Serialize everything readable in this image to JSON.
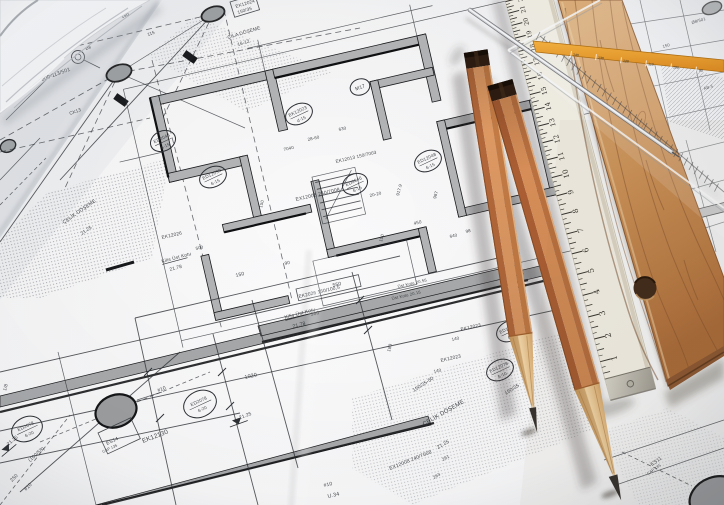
{
  "scene_colors": {
    "paper": "#f6f6f7",
    "blueprint_ink": "#2e3135",
    "wall_fill": "#b3b5b7",
    "pencil_wood": "#e09a63",
    "ruler_wood": "#c88f5e",
    "ruler_cream": "#f1eee4",
    "stripe_orange": "#efa33c",
    "graphite": "#332f2c"
  },
  "white_ruler": {
    "numbers": [
      "0",
      "1",
      "2",
      "3",
      "4",
      "5",
      "6",
      "7",
      "8",
      "9",
      "10",
      "11",
      "12",
      "13",
      "14",
      "15",
      "16",
      "17",
      "18",
      "19",
      "20",
      "21",
      "22",
      "23"
    ]
  },
  "set_square": {
    "scale_numbers": [
      "140",
      "130",
      "120",
      "110",
      "100",
      "90"
    ]
  },
  "blueprint": {
    "labels": [
      {
        "t": "EK12024",
        "x": 236,
        "y": 8,
        "r": -17,
        "s": 4.6
      },
      {
        "t": "150/35",
        "x": 238,
        "y": 14,
        "r": -17,
        "s": 4.6
      },
      {
        "t": "ÇILA DÖŞEME",
        "x": 228,
        "y": 39,
        "r": -17,
        "s": 4.8
      },
      {
        "t": "16-12",
        "x": 238,
        "y": 46,
        "r": -17,
        "s": 4.6
      },
      {
        "t": "800-113/501",
        "x": 42,
        "y": 81,
        "r": -20,
        "s": 5.2
      },
      {
        "t": "CK13",
        "x": 70,
        "y": 115,
        "r": -20,
        "s": 4.6
      },
      {
        "t": "-180/501",
        "x": 60,
        "y": 9,
        "r": -20,
        "s": 4.4
      },
      {
        "t": "150",
        "x": 122,
        "y": 18,
        "r": -20,
        "s": 4.4
      },
      {
        "t": "115",
        "x": 148,
        "y": 36,
        "r": -20,
        "s": 4.4
      },
      {
        "t": "Ø8",
        "x": 86,
        "y": 50,
        "r": -20,
        "s": 4
      },
      {
        "t": "EX12008  240/7008",
        "x": 296,
        "y": 201,
        "r": -13,
        "s": 5
      },
      {
        "t": "EK12013  150/7003",
        "x": 336,
        "y": 163,
        "r": -13,
        "s": 4.6
      },
      {
        "t": "28-60",
        "x": 308,
        "y": 141,
        "r": -13,
        "s": 4.4
      },
      {
        "t": "7040",
        "x": 284,
        "y": 151,
        "r": -13,
        "s": 4.4
      },
      {
        "t": "20-20",
        "x": 370,
        "y": 197,
        "r": -13,
        "s": 4.4
      },
      {
        "t": "917.9",
        "x": 399,
        "y": 196,
        "r": -75,
        "s": 4.4
      },
      {
        "t": "987",
        "x": 436,
        "y": 199,
        "r": -75,
        "s": 4.4
      },
      {
        "t": "450",
        "x": 414,
        "y": 225,
        "r": -13,
        "s": 4.6
      },
      {
        "t": "630",
        "x": 339,
        "y": 131,
        "r": -13,
        "s": 4.4
      },
      {
        "t": "640",
        "x": 450,
        "y": 238,
        "r": -13,
        "s": 4.4
      },
      {
        "t": "98",
        "x": 466,
        "y": 233,
        "r": -13,
        "s": 4.4
      },
      {
        "t": "150",
        "x": 262,
        "y": 208,
        "r": -75,
        "s": 4.4
      },
      {
        "t": "150",
        "x": 382,
        "y": 242,
        "r": -75,
        "s": 4.4
      },
      {
        "t": "EK12023",
        "x": 461,
        "y": 331,
        "r": -13,
        "s": 4.8
      },
      {
        "t": "140",
        "x": 452,
        "y": 341,
        "r": -13,
        "s": 4.4
      },
      {
        "t": "EK12023",
        "x": 441,
        "y": 362,
        "r": -13,
        "s": 4.8
      },
      {
        "t": "140",
        "x": 434,
        "y": 373,
        "r": -13,
        "s": 4.4
      },
      {
        "t": "150/35-50",
        "x": 414,
        "y": 392,
        "r": -33,
        "s": 5
      },
      {
        "t": "150/35",
        "x": 506,
        "y": 395,
        "r": -33,
        "s": 5
      },
      {
        "t": "Kilis Üst Kotu",
        "x": 162,
        "y": 263,
        "r": -15,
        "s": 4.8,
        "u": 26
      },
      {
        "t": "21.78",
        "x": 170,
        "y": 271,
        "r": -15,
        "s": 4.8
      },
      {
        "t": "Kilis Üst Kotu",
        "x": 285,
        "y": 319,
        "r": -15,
        "s": 5,
        "u": 28
      },
      {
        "t": "21.78",
        "x": 293,
        "y": 328,
        "r": -15,
        "s": 5
      },
      {
        "t": "EK2026  150/100,5",
        "x": 299,
        "y": 298,
        "r": -13,
        "s": 4.8
      },
      {
        "t": "550",
        "x": 333,
        "y": 287,
        "r": -13,
        "s": 5
      },
      {
        "t": "360",
        "x": 311,
        "y": 316,
        "r": -13,
        "s": 5
      },
      {
        "t": "150",
        "x": 236,
        "y": 277,
        "r": -13,
        "s": 5
      },
      {
        "t": "90",
        "x": 285,
        "y": 265,
        "r": -13,
        "s": 4.6
      },
      {
        "t": "180",
        "x": 390,
        "y": 352,
        "r": -75,
        "s": 4.6
      },
      {
        "t": "1020",
        "x": 245,
        "y": 379,
        "r": -13,
        "s": 5.4
      },
      {
        "t": "#10",
        "x": 158,
        "y": 392,
        "r": -20,
        "s": 5
      },
      {
        "t": "EK12130",
        "x": 143,
        "y": 443,
        "r": -21,
        "s": 6.4
      },
      {
        "t": "ES14",
        "x": 107,
        "y": 445,
        "r": -25,
        "s": 5
      },
      {
        "t": "CAP 135",
        "x": 103,
        "y": 453,
        "r": -25,
        "s": 3.8
      },
      {
        "t": "(100/58)",
        "x": 30,
        "y": 462,
        "r": -42,
        "s": 5
      },
      {
        "t": "#10",
        "x": 26,
        "y": 491,
        "r": -45,
        "s": 5
      },
      {
        "t": "250",
        "x": 12,
        "y": 482,
        "r": -45,
        "s": 5
      },
      {
        "t": "1/8",
        "x": 6,
        "y": 391,
        "r": -75,
        "s": 4.6
      },
      {
        "t": "ÇELİK DÖŞEME",
        "x": 64,
        "y": 224,
        "r": -35,
        "s": 5
      },
      {
        "t": "21.25",
        "x": 82,
        "y": 235,
        "r": -35,
        "s": 4.6
      },
      {
        "t": "EK12026",
        "x": 162,
        "y": 239,
        "r": -13,
        "s": 4.8
      },
      {
        "t": "500",
        "x": 196,
        "y": 250,
        "r": -13,
        "s": 4.4
      },
      {
        "t": "ÇELİK DÖŞEME",
        "x": 424,
        "y": 426,
        "r": -30,
        "s": 6
      },
      {
        "t": "21.25",
        "x": 438,
        "y": 449,
        "r": -30,
        "s": 5
      },
      {
        "t": "261",
        "x": 443,
        "y": 461,
        "r": -30,
        "s": 4.4
      },
      {
        "t": "263",
        "x": 434,
        "y": 479,
        "r": -30,
        "s": 4.4
      },
      {
        "t": "EX12008  240/7008",
        "x": 390,
        "y": 470,
        "r": -22,
        "s": 5
      },
      {
        "t": "U.34",
        "x": 328,
        "y": 498,
        "r": -13,
        "s": 5.4
      },
      {
        "t": "#10",
        "x": 324,
        "y": 487,
        "r": -13,
        "s": 5
      },
      {
        "t": "ES11",
        "x": 652,
        "y": 466,
        "r": -35,
        "s": 5
      },
      {
        "t": "CAP 135",
        "x": 648,
        "y": 475,
        "r": -35,
        "s": 3.8
      },
      {
        "t": "Ø8/501",
        "x": 692,
        "y": 24,
        "r": -16,
        "s": 4.2
      },
      {
        "t": "150",
        "x": 663,
        "y": 48,
        "r": -16,
        "s": 4.2
      },
      {
        "t": "AB-5",
        "x": 704,
        "y": 90,
        "r": -16,
        "s": 4.2
      },
      {
        "t": "Üst Kotu 20.55",
        "x": 398,
        "y": 288,
        "r": -13,
        "s": 4.2
      },
      {
        "t": "Üst Kotu 20.15",
        "x": 392,
        "y": 300,
        "r": -13,
        "s": 4.2
      }
    ],
    "circled_labels": [
      {
        "l1": "M17",
        "l2": "",
        "x": 360,
        "y": 87,
        "r": -20,
        "rx": 10,
        "ry": 8
      },
      {
        "l1": "EK12023",
        "l2": "d-15",
        "x": 299,
        "y": 114,
        "r": -25,
        "rx": 14,
        "ry": 10
      },
      {
        "l1": "ED12039",
        "l2": "6-15",
        "x": 213,
        "y": 177,
        "r": -25,
        "rx": 14,
        "ry": 10
      },
      {
        "l1": "ED2048",
        "l2": "6-15",
        "x": 163,
        "y": 141,
        "r": -25,
        "rx": 13,
        "ry": 10
      },
      {
        "l1": "ED12048",
        "l2": "6-15",
        "x": 428,
        "y": 161,
        "r": -25,
        "rx": 14,
        "ry": 10
      },
      {
        "l1": "ED2046",
        "l2": "6-15",
        "x": 355,
        "y": 184,
        "r": -25,
        "rx": 13,
        "ry": 10
      },
      {
        "l1": "ED12014",
        "l2": "6-10",
        "x": 510,
        "y": 331,
        "r": -25,
        "rx": 14,
        "ry": 10
      },
      {
        "l1": "ED12078",
        "l2": "6-10",
        "x": 500,
        "y": 370,
        "r": -25,
        "rx": 14,
        "ry": 10
      },
      {
        "l1": "ED2078",
        "l2": "6-20",
        "x": 200,
        "y": 404,
        "r": -25,
        "rx": 17,
        "ry": 13
      },
      {
        "l1": "ED2078",
        "l2": "6-20",
        "x": 27,
        "y": 429,
        "r": -25,
        "rx": 16,
        "ry": 12
      }
    ],
    "boxes": [
      {
        "x": 296,
        "y": 289,
        "w": 64,
        "h": 12,
        "r": -13
      },
      {
        "x": 98,
        "y": 433,
        "w": 36,
        "h": 23,
        "r": -25
      },
      {
        "x": 56,
        "y": 2,
        "w": 30,
        "h": 10,
        "r": -20
      },
      {
        "x": 230,
        "y": 2,
        "w": 26,
        "h": 16,
        "r": -17
      }
    ],
    "level_marks": [
      {
        "t": "21.25",
        "x": 238,
        "y": 423,
        "r": -20
      },
      {
        "t": "21.25",
        "x": 8,
        "y": 450,
        "r": -40
      }
    ]
  }
}
